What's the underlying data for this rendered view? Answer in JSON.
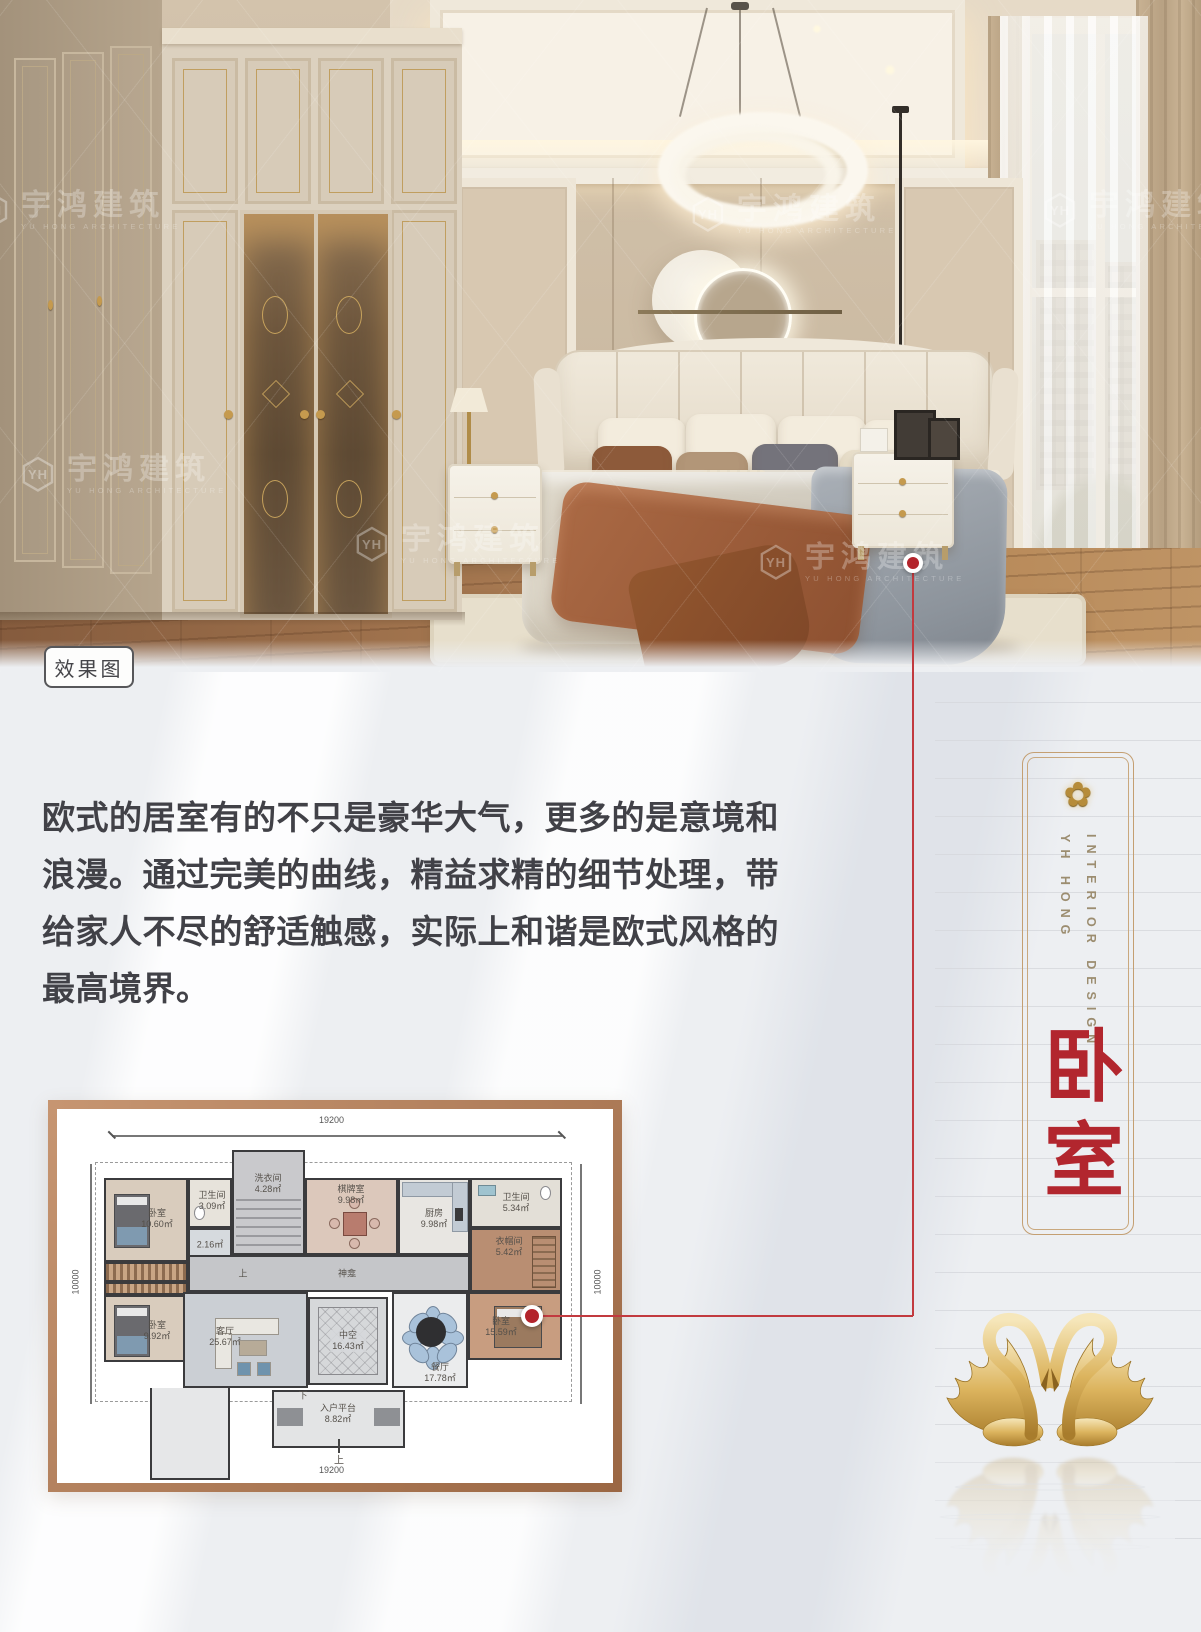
{
  "photo": {
    "tag": "效果图"
  },
  "watermark": {
    "logo": "YH",
    "brand": "宇鸿建筑",
    "sub": "YU HONG ARCHITECTURE"
  },
  "description": {
    "lines": [
      "欧式的居室有的不只是豪华大气，更多的是意境和",
      "浪漫。通过完美的曲线，精益求精的细节处理，带",
      "给家人不尽的舒适触感，实际上和谐是欧式风格的",
      "最高境界。"
    ]
  },
  "panel": {
    "en_title": "INTERIOR DESIGN",
    "en_subtitle": "YH HONG",
    "title": "卧室",
    "flower_icon": "✿"
  },
  "plan": {
    "dims": {
      "top": "19200",
      "bottom": "19200",
      "left": "10000",
      "right": "10000"
    },
    "rooms": {
      "bedroom1": {
        "name": "卧室",
        "area": "10.60㎡"
      },
      "bath1": {
        "name": "卫生间",
        "area": "3.09㎡"
      },
      "store": {
        "name": "",
        "area": "2.16㎡"
      },
      "laundry": {
        "name": "洗衣间",
        "area": "4.28㎡"
      },
      "mahjong": {
        "name": "棋牌室",
        "area": "9.98㎡"
      },
      "kitchen": {
        "name": "厨房",
        "area": "9.98㎡"
      },
      "bath2": {
        "name": "卫生间",
        "area": "5.34㎡"
      },
      "closet": {
        "name": "衣帽间",
        "area": "5.42㎡"
      },
      "master": {
        "name": "卧室",
        "area": "15.59㎡"
      },
      "bedroom2": {
        "name": "卧室",
        "area": "9.92㎡"
      },
      "living": {
        "name": "客厅",
        "area": "25.67㎡"
      },
      "atrium": {
        "name": "中空",
        "area": "16.43㎡"
      },
      "dining": {
        "name": "餐厅",
        "area": "17.78㎡"
      },
      "platform": {
        "name": "入户平台",
        "area": "8.82㎡"
      }
    },
    "labels": {
      "up": "上",
      "down": "下",
      "shrine": "神龛"
    }
  },
  "colors": {
    "accent_red": "#b2262e",
    "gold": "#c49f72",
    "frame_brown": "#b5815e"
  }
}
